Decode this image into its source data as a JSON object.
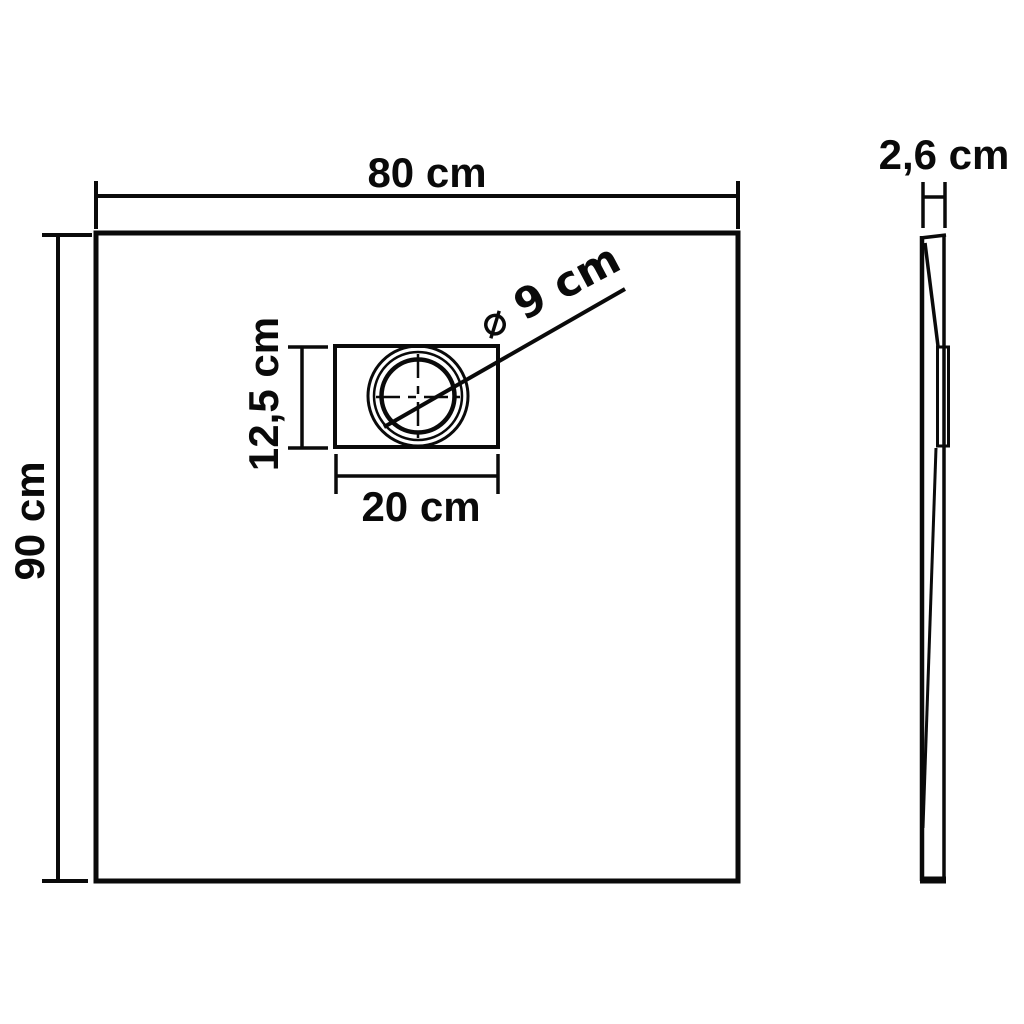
{
  "drawing": {
    "type": "technical dimension drawing",
    "subject": "square shower base tray with drain, top view and side profile",
    "background_color": "#ffffff",
    "line_color": "#0a0a0a",
    "top_view": {
      "width": {
        "label": "80 cm",
        "value_cm": 80
      },
      "height": {
        "label": "90 cm",
        "value_cm": 90
      },
      "drain_recess": {
        "width": {
          "label": "20 cm",
          "value_cm": 20
        },
        "height": {
          "label": "12,5 cm",
          "value_cm": 12.5
        },
        "drain_diameter": {
          "label": "⌀ 9 cm",
          "value_cm": 9
        }
      }
    },
    "side_view": {
      "thickness": {
        "label": "2,6 cm",
        "value_cm": 2.6
      }
    }
  }
}
